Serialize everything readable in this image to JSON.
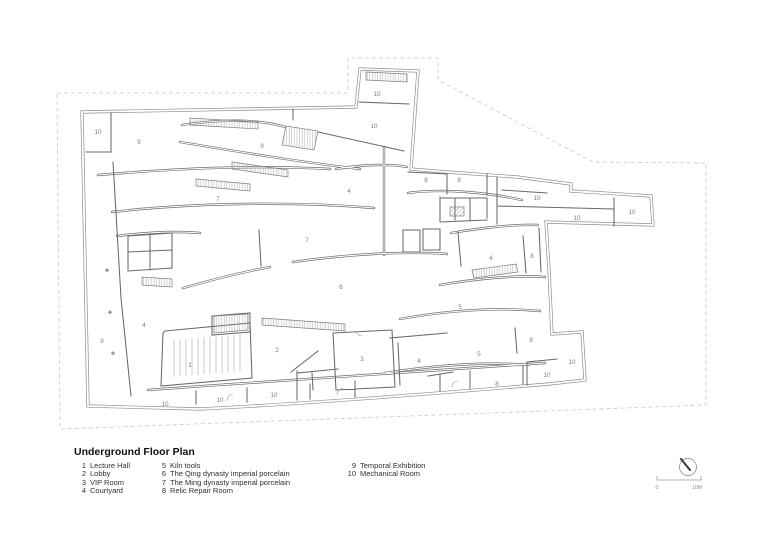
{
  "title": "Underground Floor Plan",
  "legend": {
    "columns": [
      {
        "items": [
          {
            "num": "1",
            "label": "Lecture Hall"
          },
          {
            "num": "2",
            "label": "Lobby"
          },
          {
            "num": "3",
            "label": "VIP Room"
          },
          {
            "num": "4",
            "label": "Courtyard"
          }
        ]
      },
      {
        "items": [
          {
            "num": "5",
            "label": "Kiln tools"
          },
          {
            "num": "6",
            "label": "The Qing dynasty imperial porcelain"
          },
          {
            "num": "7",
            "label": "The Ming dynasty imperial porcelain"
          },
          {
            "num": "8",
            "label": "Relic Repair Room"
          }
        ]
      },
      {
        "items": [
          {
            "num": "9",
            "label": "Temporal Exhibition"
          },
          {
            "num": "10",
            "label": "Mechanical Room"
          }
        ]
      }
    ]
  },
  "scale_bar": {
    "start_label": "0",
    "end_label": "10M"
  },
  "compass": {
    "icon": "north-indicator"
  },
  "colors": {
    "wall_dark": "#686868",
    "wall_outer": "#8f8f8f",
    "dashed_boundary": "#c9c9c9",
    "room_label": "#7d7d7d",
    "hatch": "#b0b0b0"
  },
  "plan": {
    "room_labels": [
      {
        "n": "10",
        "x": 98,
        "y": 134
      },
      {
        "n": "9",
        "x": 139,
        "y": 144
      },
      {
        "n": "9",
        "x": 262,
        "y": 148
      },
      {
        "n": "10",
        "x": 377,
        "y": 96
      },
      {
        "n": "10",
        "x": 374,
        "y": 128
      },
      {
        "n": "7",
        "x": 218,
        "y": 201
      },
      {
        "n": "4",
        "x": 349,
        "y": 193
      },
      {
        "n": "8",
        "x": 426,
        "y": 182
      },
      {
        "n": "8",
        "x": 459,
        "y": 182
      },
      {
        "n": "10",
        "x": 537,
        "y": 200
      },
      {
        "n": "10",
        "x": 577,
        "y": 220
      },
      {
        "n": "10",
        "x": 632,
        "y": 214
      },
      {
        "n": "7",
        "x": 307,
        "y": 242
      },
      {
        "n": "6",
        "x": 341,
        "y": 289
      },
      {
        "n": "4",
        "x": 144,
        "y": 327
      },
      {
        "n": "9",
        "x": 102,
        "y": 343
      },
      {
        "n": "1",
        "x": 190,
        "y": 367
      },
      {
        "n": "2",
        "x": 277,
        "y": 352
      },
      {
        "n": "3",
        "x": 362,
        "y": 361
      },
      {
        "n": "4",
        "x": 419,
        "y": 363
      },
      {
        "n": "5",
        "x": 460,
        "y": 309
      },
      {
        "n": "5",
        "x": 479,
        "y": 356
      },
      {
        "n": "4",
        "x": 491,
        "y": 260
      },
      {
        "n": "8",
        "x": 532,
        "y": 258
      },
      {
        "n": "8",
        "x": 531,
        "y": 342
      },
      {
        "n": "8",
        "x": 497,
        "y": 386
      },
      {
        "n": "10",
        "x": 547,
        "y": 377
      },
      {
        "n": "10",
        "x": 572,
        "y": 364
      },
      {
        "n": "10",
        "x": 165,
        "y": 406
      },
      {
        "n": "10",
        "x": 220,
        "y": 402
      },
      {
        "n": "10",
        "x": 274,
        "y": 397
      }
    ]
  }
}
